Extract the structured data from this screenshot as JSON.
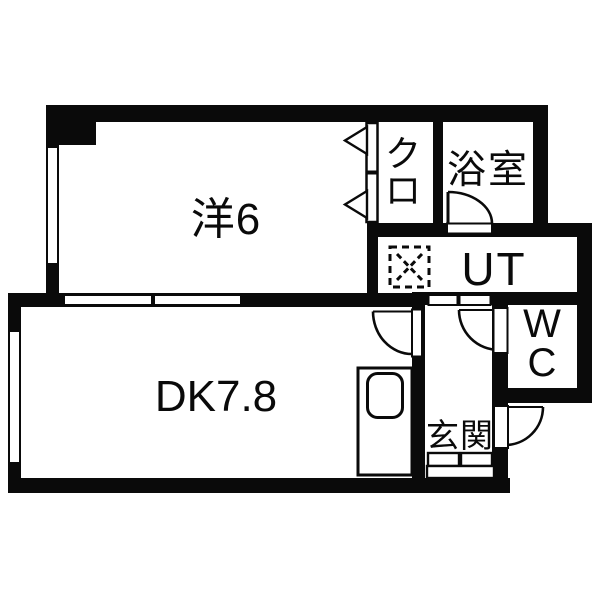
{
  "colors": {
    "wall": "#0a0a0a",
    "floor": "#ffffff"
  },
  "floor_plan": {
    "rooms": {
      "western": {
        "label": "洋6"
      },
      "dining_kitchen": {
        "label": "DK7.8"
      },
      "closet": {
        "char1": "ク",
        "char2": "ロ"
      },
      "bathroom": {
        "label": "浴室"
      },
      "utility": {
        "label": "UT"
      },
      "toilet": {
        "char1": "W",
        "char2": "C"
      },
      "entrance": {
        "label": "玄関"
      }
    }
  }
}
